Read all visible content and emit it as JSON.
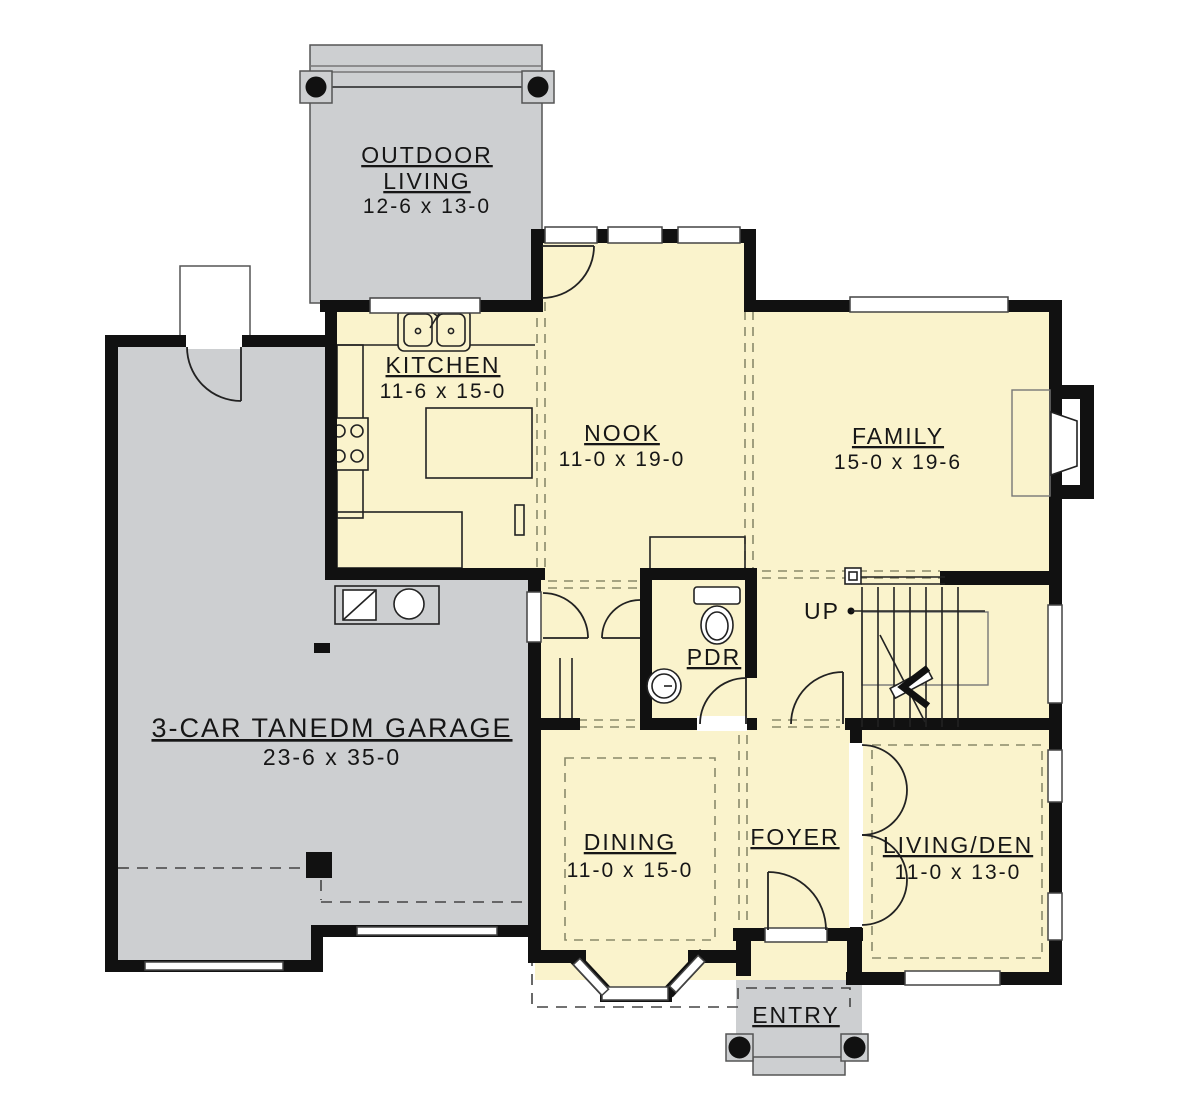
{
  "plan_title": "First floor plan",
  "colors": {
    "interior_fill": "#FAF3CC",
    "exterior_gray": "#CDCFD1",
    "wall": "#111111",
    "background": "#FFFFFF"
  },
  "rooms": {
    "outdoor_living": {
      "name_line1": "OUTDOOR",
      "name_line2": "LIVING",
      "dims": "12-6 x 13-0"
    },
    "kitchen": {
      "name": "KITCHEN",
      "dims": "11-6 x 15-0"
    },
    "nook": {
      "name": "NOOK",
      "dims": "11-0 x 19-0"
    },
    "family": {
      "name": "FAMILY",
      "dims": "15-0 x 19-6"
    },
    "garage": {
      "name": "3-CAR TANEDM GARAGE",
      "dims": "23-6 x 35-0"
    },
    "powder": {
      "name": "PDR"
    },
    "dining": {
      "name": "DINING",
      "dims": "11-0 x 15-0"
    },
    "foyer": {
      "name": "FOYER"
    },
    "living_den": {
      "name": "LIVING/DEN",
      "dims": "11-0 x 13-0"
    },
    "entry": {
      "name": "ENTRY"
    },
    "stairs": {
      "direction_label": "UP"
    }
  }
}
